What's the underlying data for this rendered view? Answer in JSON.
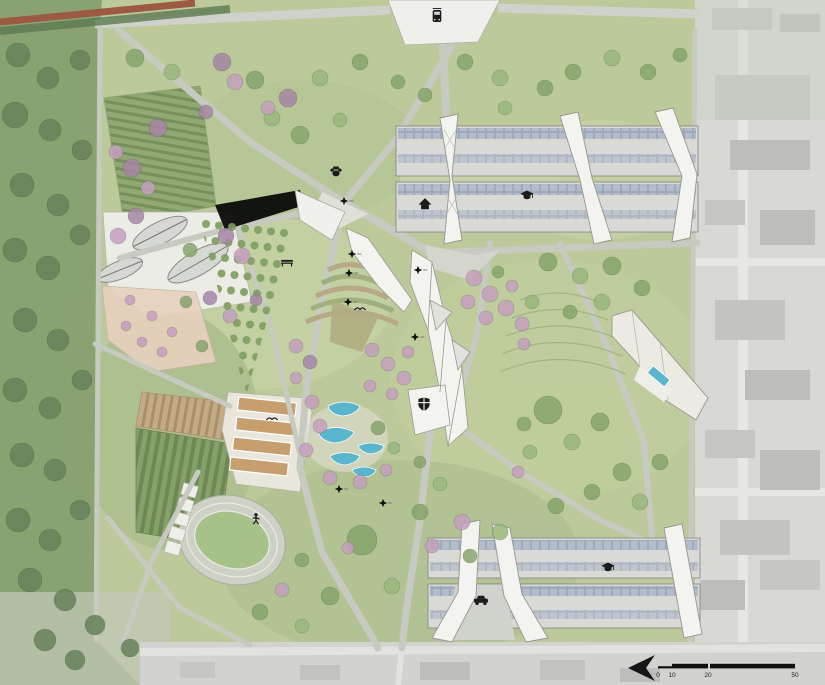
{
  "meta": {
    "drawing_type": "landscape masterplan site plan",
    "rendering_style": "watercolor aerial plan"
  },
  "scale_bar": {
    "labels": [
      "0",
      "10",
      "20",
      "50"
    ]
  },
  "north_arrow": {
    "direction": "left"
  },
  "palette": {
    "f": "#66815a",
    "g": "#86a46c",
    "g2": "#99b67d",
    "p": "#a586a4",
    "q": "#c49fbd",
    "water": "#5ab6cc",
    "path": "#c7cac0",
    "building": "#d9d9d5",
    "fold": "#f3f3ef",
    "lawn": "#bcc99b",
    "forest": "#8aa272",
    "urban": "#d8d8d5"
  },
  "icons": [
    {
      "type": "tram",
      "name": "tram-stop-icon",
      "x": 437,
      "y": 16,
      "s": 1.2
    },
    {
      "type": "paw",
      "name": "paw-icon",
      "x": 336,
      "y": 171,
      "s": 1.5
    },
    {
      "type": "house",
      "name": "house-icon",
      "x": 425,
      "y": 204,
      "s": 1.3
    },
    {
      "type": "gradcap",
      "name": "graduation-cap-icon",
      "x": 527,
      "y": 195,
      "s": 1.2
    },
    {
      "type": "gradcap",
      "name": "graduation-cap-icon",
      "x": 608,
      "y": 567,
      "s": 1.2
    },
    {
      "type": "shield",
      "name": "shield-icon",
      "x": 424,
      "y": 404,
      "s": 1.4
    },
    {
      "type": "car",
      "name": "vehicles-icon",
      "x": 481,
      "y": 600,
      "s": 1.4
    },
    {
      "type": "bench",
      "name": "bench-icon",
      "x": 287,
      "y": 262,
      "s": 1.3
    },
    {
      "type": "person",
      "name": "athlete-icon",
      "x": 256,
      "y": 519,
      "s": 1.3
    },
    {
      "type": "bird",
      "name": "bird-icon",
      "x": 272,
      "y": 420,
      "s": 1.1
    },
    {
      "type": "bird",
      "name": "bird-icon",
      "x": 360,
      "y": 310,
      "s": 1.1
    }
  ],
  "spot_markers": [
    [
      344,
      201
    ],
    [
      352,
      254
    ],
    [
      349,
      273
    ],
    [
      348,
      302
    ],
    [
      418,
      270
    ],
    [
      415,
      337
    ],
    [
      339,
      489
    ],
    [
      383,
      503
    ]
  ],
  "orchard": {
    "x0": 206,
    "y0": 224,
    "cols": 7,
    "rows": 11,
    "dx": 13,
    "dy": 15.5,
    "rowShift": -3.5,
    "colShift": 1.5,
    "r": 4,
    "color": "#7e9d60"
  },
  "trees": [
    [
      18,
      55,
      12,
      "f"
    ],
    [
      48,
      78,
      11,
      "f"
    ],
    [
      80,
      60,
      10,
      "f"
    ],
    [
      15,
      115,
      13,
      "f"
    ],
    [
      50,
      130,
      11,
      "f"
    ],
    [
      82,
      150,
      10,
      "f"
    ],
    [
      22,
      185,
      12,
      "f"
    ],
    [
      58,
      205,
      11,
      "f"
    ],
    [
      15,
      250,
      12,
      "f"
    ],
    [
      48,
      268,
      12,
      "f"
    ],
    [
      80,
      235,
      10,
      "f"
    ],
    [
      25,
      320,
      12,
      "f"
    ],
    [
      58,
      340,
      11,
      "f"
    ],
    [
      15,
      390,
      12,
      "f"
    ],
    [
      50,
      408,
      11,
      "f"
    ],
    [
      82,
      380,
      10,
      "f"
    ],
    [
      22,
      455,
      12,
      "f"
    ],
    [
      55,
      470,
      11,
      "f"
    ],
    [
      18,
      520,
      12,
      "f"
    ],
    [
      50,
      540,
      11,
      "f"
    ],
    [
      80,
      510,
      10,
      "f"
    ],
    [
      30,
      580,
      12,
      "f"
    ],
    [
      65,
      600,
      11,
      "f"
    ],
    [
      95,
      625,
      10,
      "f"
    ],
    [
      130,
      648,
      9,
      "f"
    ],
    [
      45,
      640,
      11,
      "f"
    ],
    [
      75,
      660,
      10,
      "f"
    ],
    [
      135,
      58,
      9,
      "g"
    ],
    [
      172,
      72,
      8,
      "g2"
    ],
    [
      255,
      80,
      9,
      "g"
    ],
    [
      320,
      78,
      8,
      "g2"
    ],
    [
      360,
      62,
      8,
      "g"
    ],
    [
      398,
      82,
      7,
      "g"
    ],
    [
      465,
      62,
      8,
      "g"
    ],
    [
      500,
      78,
      8,
      "g2"
    ],
    [
      573,
      72,
      8,
      "g"
    ],
    [
      612,
      58,
      8,
      "g2"
    ],
    [
      648,
      72,
      8,
      "g"
    ],
    [
      680,
      55,
      7,
      "g"
    ],
    [
      300,
      135,
      9,
      "g"
    ],
    [
      272,
      118,
      8,
      "g2"
    ],
    [
      425,
      95,
      7,
      "g"
    ],
    [
      545,
      88,
      8,
      "g"
    ],
    [
      505,
      108,
      7,
      "g2"
    ],
    [
      340,
      120,
      7,
      "g2"
    ],
    [
      222,
      62,
      9,
      "p"
    ],
    [
      235,
      82,
      8,
      "q"
    ],
    [
      288,
      98,
      9,
      "p"
    ],
    [
      268,
      108,
      7,
      "q"
    ],
    [
      158,
      128,
      9,
      "p"
    ],
    [
      132,
      168,
      9,
      "p"
    ],
    [
      148,
      188,
      7,
      "q"
    ],
    [
      116,
      152,
      7,
      "q"
    ],
    [
      206,
      112,
      7,
      "p"
    ],
    [
      136,
      216,
      8,
      "p"
    ],
    [
      118,
      236,
      8,
      "q"
    ],
    [
      226,
      236,
      8,
      "p"
    ],
    [
      242,
      256,
      8,
      "q"
    ],
    [
      210,
      298,
      7,
      "p"
    ],
    [
      230,
      316,
      7,
      "q"
    ],
    [
      256,
      300,
      6,
      "p"
    ],
    [
      190,
      250,
      7,
      "g"
    ],
    [
      186,
      302,
      6,
      "g"
    ],
    [
      202,
      346,
      6,
      "g"
    ],
    [
      130,
      300,
      5,
      "q"
    ],
    [
      152,
      316,
      5,
      "q"
    ],
    [
      172,
      332,
      5,
      "q"
    ],
    [
      142,
      342,
      5,
      "q"
    ],
    [
      162,
      352,
      5,
      "q"
    ],
    [
      126,
      326,
      5,
      "q"
    ],
    [
      296,
      346,
      7,
      "q"
    ],
    [
      310,
      362,
      7,
      "p"
    ],
    [
      296,
      378,
      6,
      "q"
    ],
    [
      372,
      350,
      7,
      "q"
    ],
    [
      388,
      364,
      7,
      "q"
    ],
    [
      404,
      378,
      7,
      "q"
    ],
    [
      392,
      394,
      6,
      "q"
    ],
    [
      370,
      386,
      6,
      "q"
    ],
    [
      408,
      352,
      6,
      "q"
    ],
    [
      474,
      278,
      8,
      "q"
    ],
    [
      490,
      294,
      8,
      "q"
    ],
    [
      506,
      308,
      8,
      "q"
    ],
    [
      522,
      324,
      7,
      "q"
    ],
    [
      486,
      318,
      7,
      "q"
    ],
    [
      468,
      302,
      7,
      "q"
    ],
    [
      512,
      286,
      6,
      "q"
    ],
    [
      532,
      302,
      7,
      "g2"
    ],
    [
      498,
      272,
      6,
      "g"
    ],
    [
      524,
      344,
      6,
      "q"
    ],
    [
      312,
      402,
      7,
      "q"
    ],
    [
      320,
      426,
      7,
      "q"
    ],
    [
      306,
      450,
      7,
      "q"
    ],
    [
      330,
      478,
      7,
      "q"
    ],
    [
      360,
      482,
      7,
      "q"
    ],
    [
      386,
      470,
      6,
      "q"
    ],
    [
      378,
      428,
      7,
      "g"
    ],
    [
      394,
      448,
      6,
      "g2"
    ],
    [
      420,
      462,
      6,
      "g"
    ],
    [
      548,
      262,
      9,
      "g"
    ],
    [
      580,
      276,
      8,
      "g2"
    ],
    [
      612,
      266,
      9,
      "g"
    ],
    [
      642,
      288,
      8,
      "g"
    ],
    [
      602,
      302,
      8,
      "g2"
    ],
    [
      570,
      312,
      7,
      "g"
    ],
    [
      548,
      410,
      14,
      "g"
    ],
    [
      600,
      422,
      9,
      "g"
    ],
    [
      572,
      442,
      8,
      "g2"
    ],
    [
      622,
      472,
      9,
      "g"
    ],
    [
      592,
      492,
      8,
      "g"
    ],
    [
      530,
      452,
      7,
      "g2"
    ],
    [
      660,
      462,
      8,
      "g"
    ],
    [
      640,
      502,
      8,
      "g2"
    ],
    [
      556,
      506,
      8,
      "g"
    ],
    [
      524,
      424,
      7,
      "g"
    ],
    [
      518,
      472,
      6,
      "q"
    ],
    [
      362,
      540,
      15,
      "g"
    ],
    [
      330,
      596,
      9,
      "g"
    ],
    [
      392,
      586,
      8,
      "g2"
    ],
    [
      420,
      512,
      8,
      "g"
    ],
    [
      500,
      532,
      8,
      "g2"
    ],
    [
      470,
      556,
      7,
      "g"
    ],
    [
      440,
      484,
      7,
      "g2"
    ],
    [
      302,
      560,
      7,
      "g"
    ],
    [
      260,
      612,
      8,
      "g"
    ],
    [
      302,
      626,
      7,
      "g2"
    ],
    [
      462,
      522,
      8,
      "q"
    ],
    [
      432,
      546,
      7,
      "q"
    ],
    [
      348,
      548,
      6,
      "q"
    ],
    [
      282,
      590,
      7,
      "q"
    ]
  ]
}
